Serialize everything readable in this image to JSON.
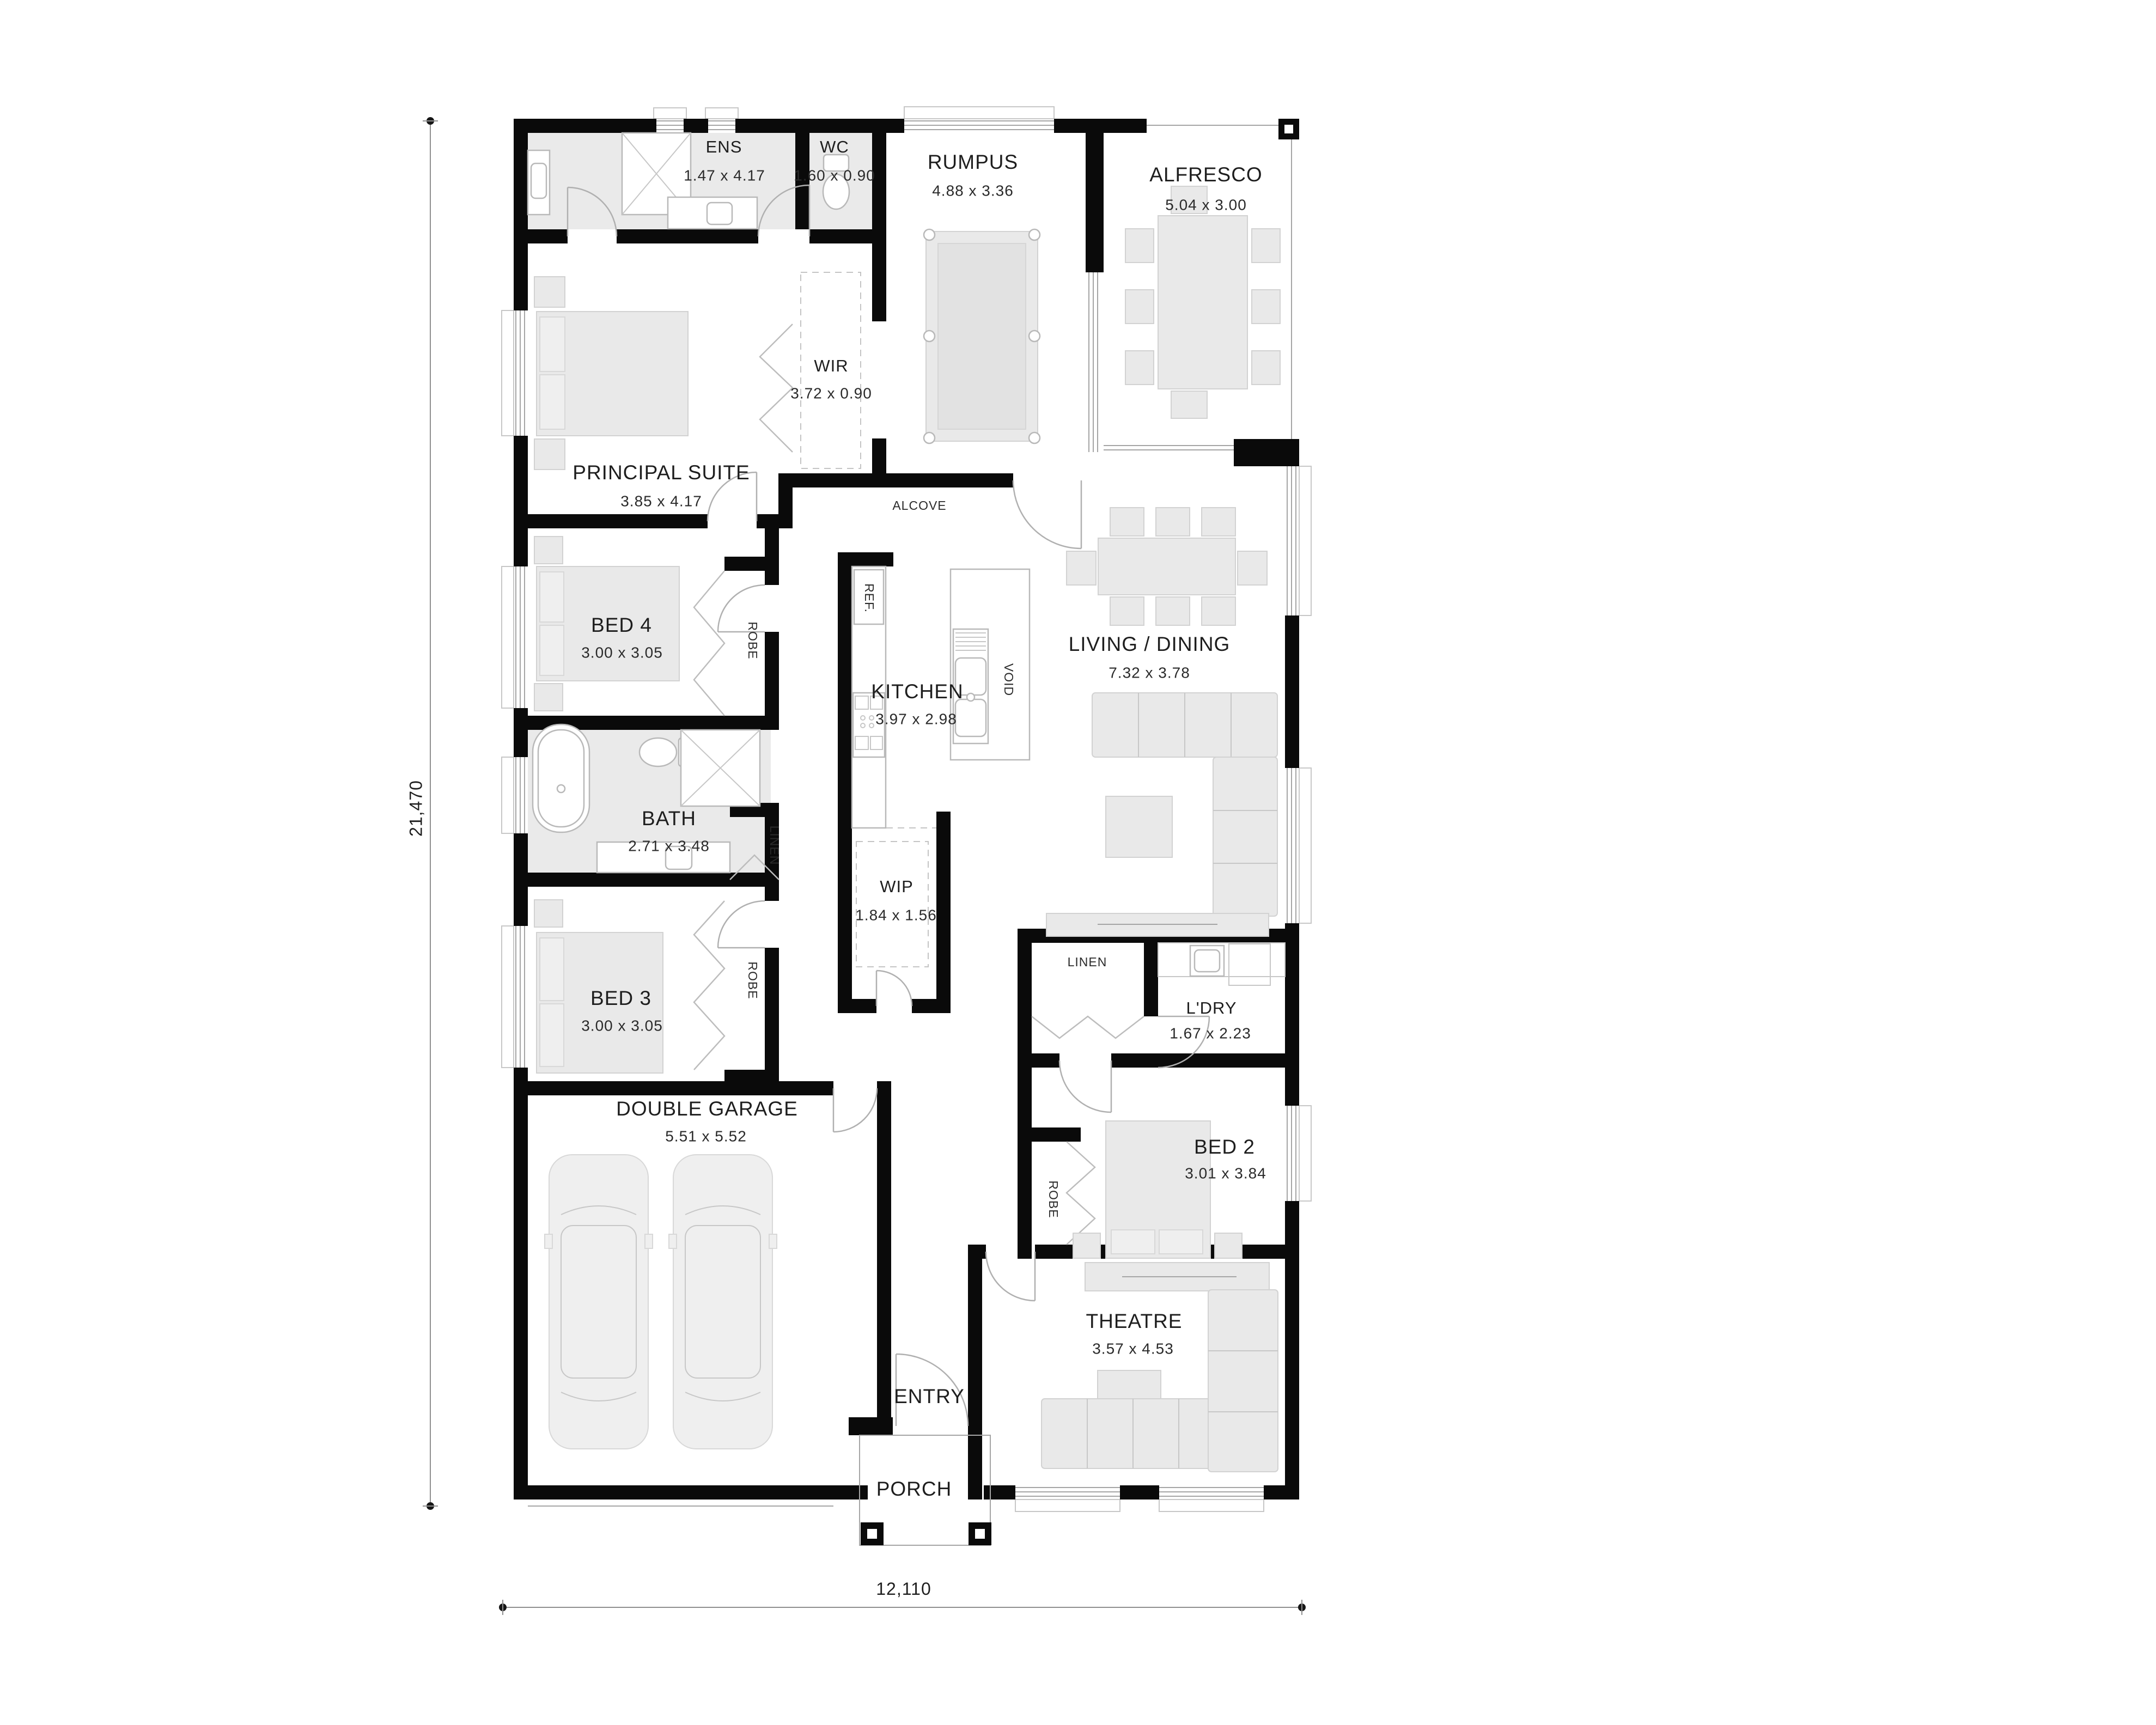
{
  "plan": {
    "rooms": {
      "ens": {
        "name": "ENS",
        "dims": "1.47 x 4.17"
      },
      "wc": {
        "name": "WC",
        "dims": "1.60 x 0.90"
      },
      "rumpus": {
        "name": "RUMPUS",
        "dims": "4.88 x 3.36"
      },
      "alfresco": {
        "name": "ALFRESCO",
        "dims": "5.04 x 3.00"
      },
      "wir": {
        "name": "WIR",
        "dims": "3.72 x 0.90"
      },
      "principal_suite": {
        "name": "PRINCIPAL SUITE",
        "dims": "3.85 x 4.17"
      },
      "alcove": {
        "name": "ALCOVE"
      },
      "bed4": {
        "name": "BED 4",
        "dims": "3.00 x 3.05"
      },
      "kitchen": {
        "name": "KITCHEN",
        "dims": "3.97 x 2.98"
      },
      "living_dining": {
        "name": "LIVING / DINING",
        "dims": "7.32 x 3.78"
      },
      "bath": {
        "name": "BATH",
        "dims": "2.71 x 3.48"
      },
      "wip": {
        "name": "WIP",
        "dims": "1.84 x 1.56"
      },
      "bed3": {
        "name": "BED 3",
        "dims": "3.00 x 3.05"
      },
      "ldry": {
        "name": "L'DRY",
        "dims": "1.67 x 2.23"
      },
      "bed2": {
        "name": "BED 2",
        "dims": "3.01 x 3.84"
      },
      "garage": {
        "name": "DOUBLE GARAGE",
        "dims": "5.51 x 5.52"
      },
      "theatre": {
        "name": "THEATRE",
        "dims": "3.57 x 4.53"
      },
      "entry": {
        "name": "ENTRY"
      },
      "porch": {
        "name": "PORCH"
      }
    },
    "fixtures": {
      "robe": "ROBE",
      "linen": "LINEN",
      "ref": "REF.",
      "void": "VOID"
    },
    "dimensions": {
      "overall_height_mm": "21,470",
      "overall_width_mm": "12,110"
    }
  }
}
